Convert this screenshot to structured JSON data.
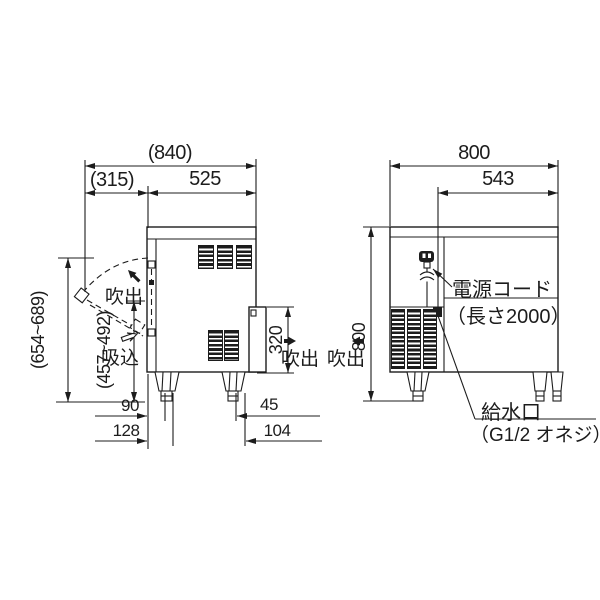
{
  "drawing": {
    "dims": {
      "overall_depth": "(840)",
      "door_open_depth": "(315)",
      "body_depth": "525",
      "front_width": "800",
      "inlet_offset": "543",
      "height": "800",
      "open_lid_height_range": "(654~689)",
      "lid_tip_height_range": "(457~492)",
      "side_outlet_height": "320",
      "front_leg_setback": "90",
      "front_leg_setback_outer": "128",
      "rear_leg_setback": "45",
      "rear_leg_setback_outer": "104"
    },
    "labels": {
      "blowout_front": "吹出",
      "suction": "吸込",
      "blowout_side_left": "吹出",
      "blowout_side_right": "吹出",
      "power_cord": "電源コード",
      "power_cord_length": "（長さ2000）",
      "water_inlet": "給水口",
      "water_inlet_thread": "（G1/2 オネジ）"
    }
  }
}
